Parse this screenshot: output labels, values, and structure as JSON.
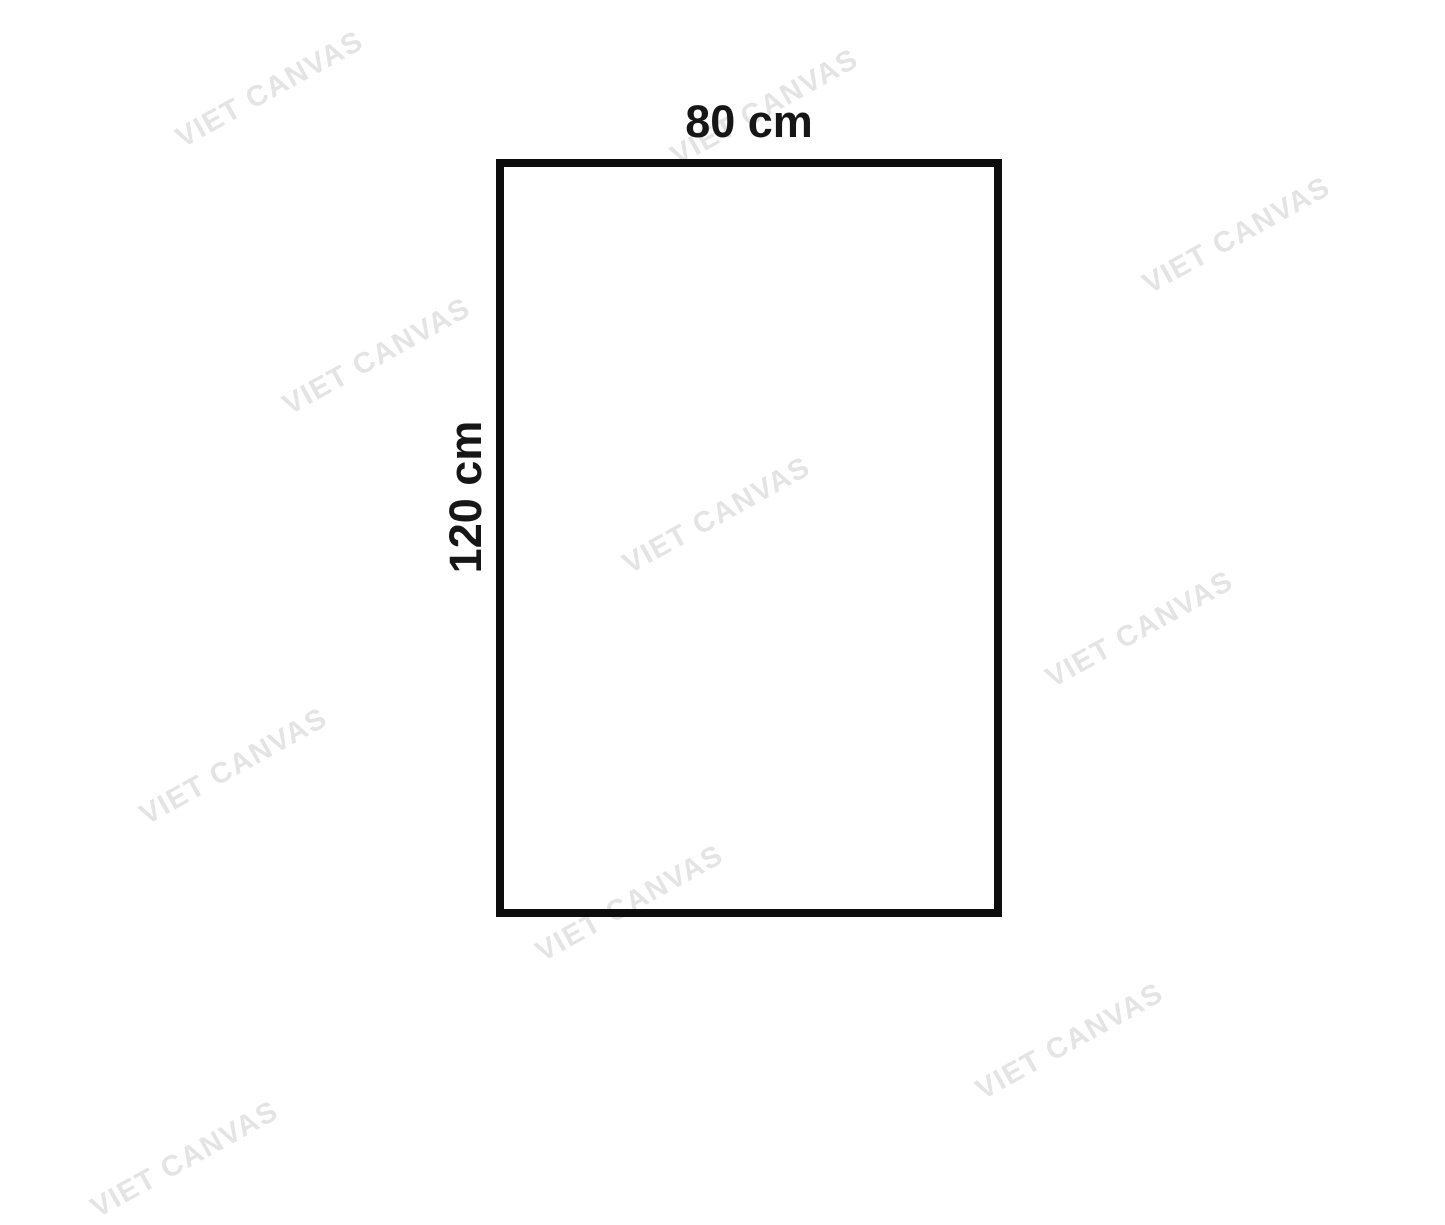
{
  "diagram": {
    "type": "canvas-size-diagram",
    "width_label": "80 cm",
    "height_label": "120 cm",
    "border_color": "#0d0d0d",
    "label_color": "#161616",
    "background_color": "#ffffff"
  },
  "watermark": {
    "text": "VIET CANVAS",
    "color": "#e4e4e4"
  }
}
